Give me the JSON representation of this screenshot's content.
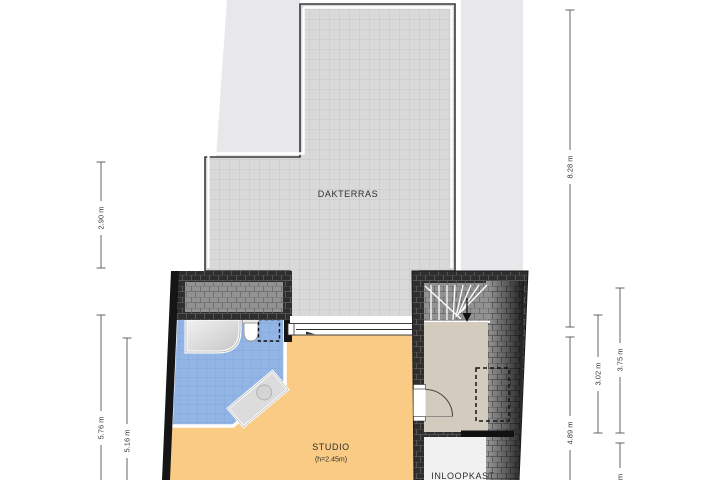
{
  "plan": {
    "rooms": {
      "dakterras": {
        "label": "DAKTERRAS"
      },
      "studio": {
        "label": "STUDIO",
        "height_note": "(h=2.45m)"
      },
      "inloopkast": {
        "label": "INLOOPKAST"
      }
    },
    "dimensions": {
      "left_outer_top": "2.90 m",
      "left_outer_bottom": "5.76 m",
      "left_inner": "5.16 m",
      "right_inner_top": "8.28 m",
      "right_inner_bottom": "4.89 m",
      "right_middle": "3.02 m",
      "right_outer": "3.75 m",
      "right_outer_bottom_partial": "m"
    },
    "colors": {
      "terrace_tile": "#d9d9d9",
      "neighbor_area": "#e8e8ea",
      "bathroom_tile": "#93b5e6",
      "studio_floor": "#f9cb85",
      "hall_floor": "#d4cbbf",
      "closet_floor": "#f1f1f1",
      "roof_hatch_dark": "#2e2e2e",
      "roof_hatch_gray": "#929292",
      "wall": "#151515"
    }
  }
}
